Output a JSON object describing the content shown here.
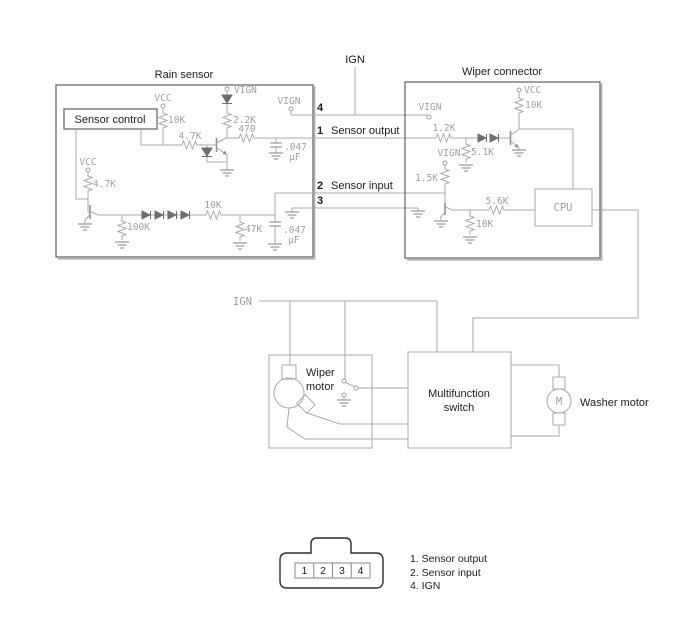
{
  "ign_top": "IGN",
  "rain": {
    "title": "Rain sensor",
    "control": "Sensor control",
    "vcc_top": "VCC",
    "r_10k_top": "10K",
    "vign_diode": "VIGN",
    "r_2_2k": "2.2K",
    "r_4_7k_top": "4.7K",
    "r_470": "470",
    "cap_top_val": ".047",
    "cap_top_unit": "µF",
    "vign_pin": "VIGN",
    "vcc_left": "VCC",
    "r_4_7k_left": "4.7K",
    "r_100k": "100K",
    "r_10k_bottom": "10K",
    "r_47k": "47K",
    "cap_bottom_val": ".047",
    "cap_bottom_unit": "µF"
  },
  "pins": {
    "p4": "4",
    "p1": "1",
    "p1_name": "Sensor output",
    "p2": "2",
    "p2_name": "Sensor input",
    "p3": "3"
  },
  "wiper": {
    "title": "Wiper connector",
    "vign_top": "VIGN",
    "r_1_2k": "1.2K",
    "vcc": "VCC",
    "r_10k_top": "10K",
    "r_5_1k": "5.1K",
    "vign_left": "VIGN",
    "r_1_5k": "1.5K",
    "r_5_6k": "5.6K",
    "r_10k_bottom": "10K",
    "cpu": "CPU"
  },
  "lower": {
    "ign": "IGN",
    "wiper_motor_line1": "Wiper",
    "wiper_motor_line2": "motor",
    "multifunction_line1": "Multifunction",
    "multifunction_line2": "switch",
    "washer_motor": "Washer motor",
    "motor_m": "M"
  },
  "connector": {
    "pin_1": "1",
    "pin_2": "2",
    "pin_3": "3",
    "pin_4": "4",
    "legend_1": "1. Sensor output",
    "legend_2": "2. Sensor input",
    "legend_3": "4. IGN"
  }
}
